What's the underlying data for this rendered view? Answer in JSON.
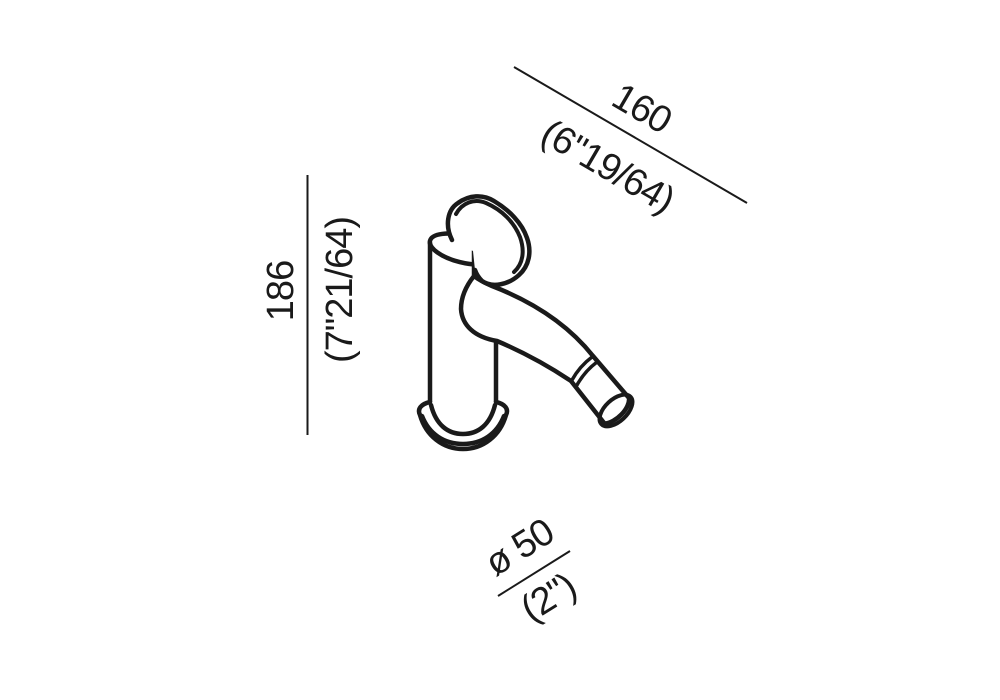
{
  "page": {
    "background_color": "#ffffff",
    "line_color": "#1a1a1a"
  },
  "dimensions": {
    "height": {
      "metric": "186",
      "imperial": "(7\"21/64)"
    },
    "spout_reach": {
      "metric": "160",
      "imperial": "(6\"19/64)"
    },
    "base_diameter": {
      "metric": "ø 50",
      "imperial": "(2\")"
    }
  }
}
